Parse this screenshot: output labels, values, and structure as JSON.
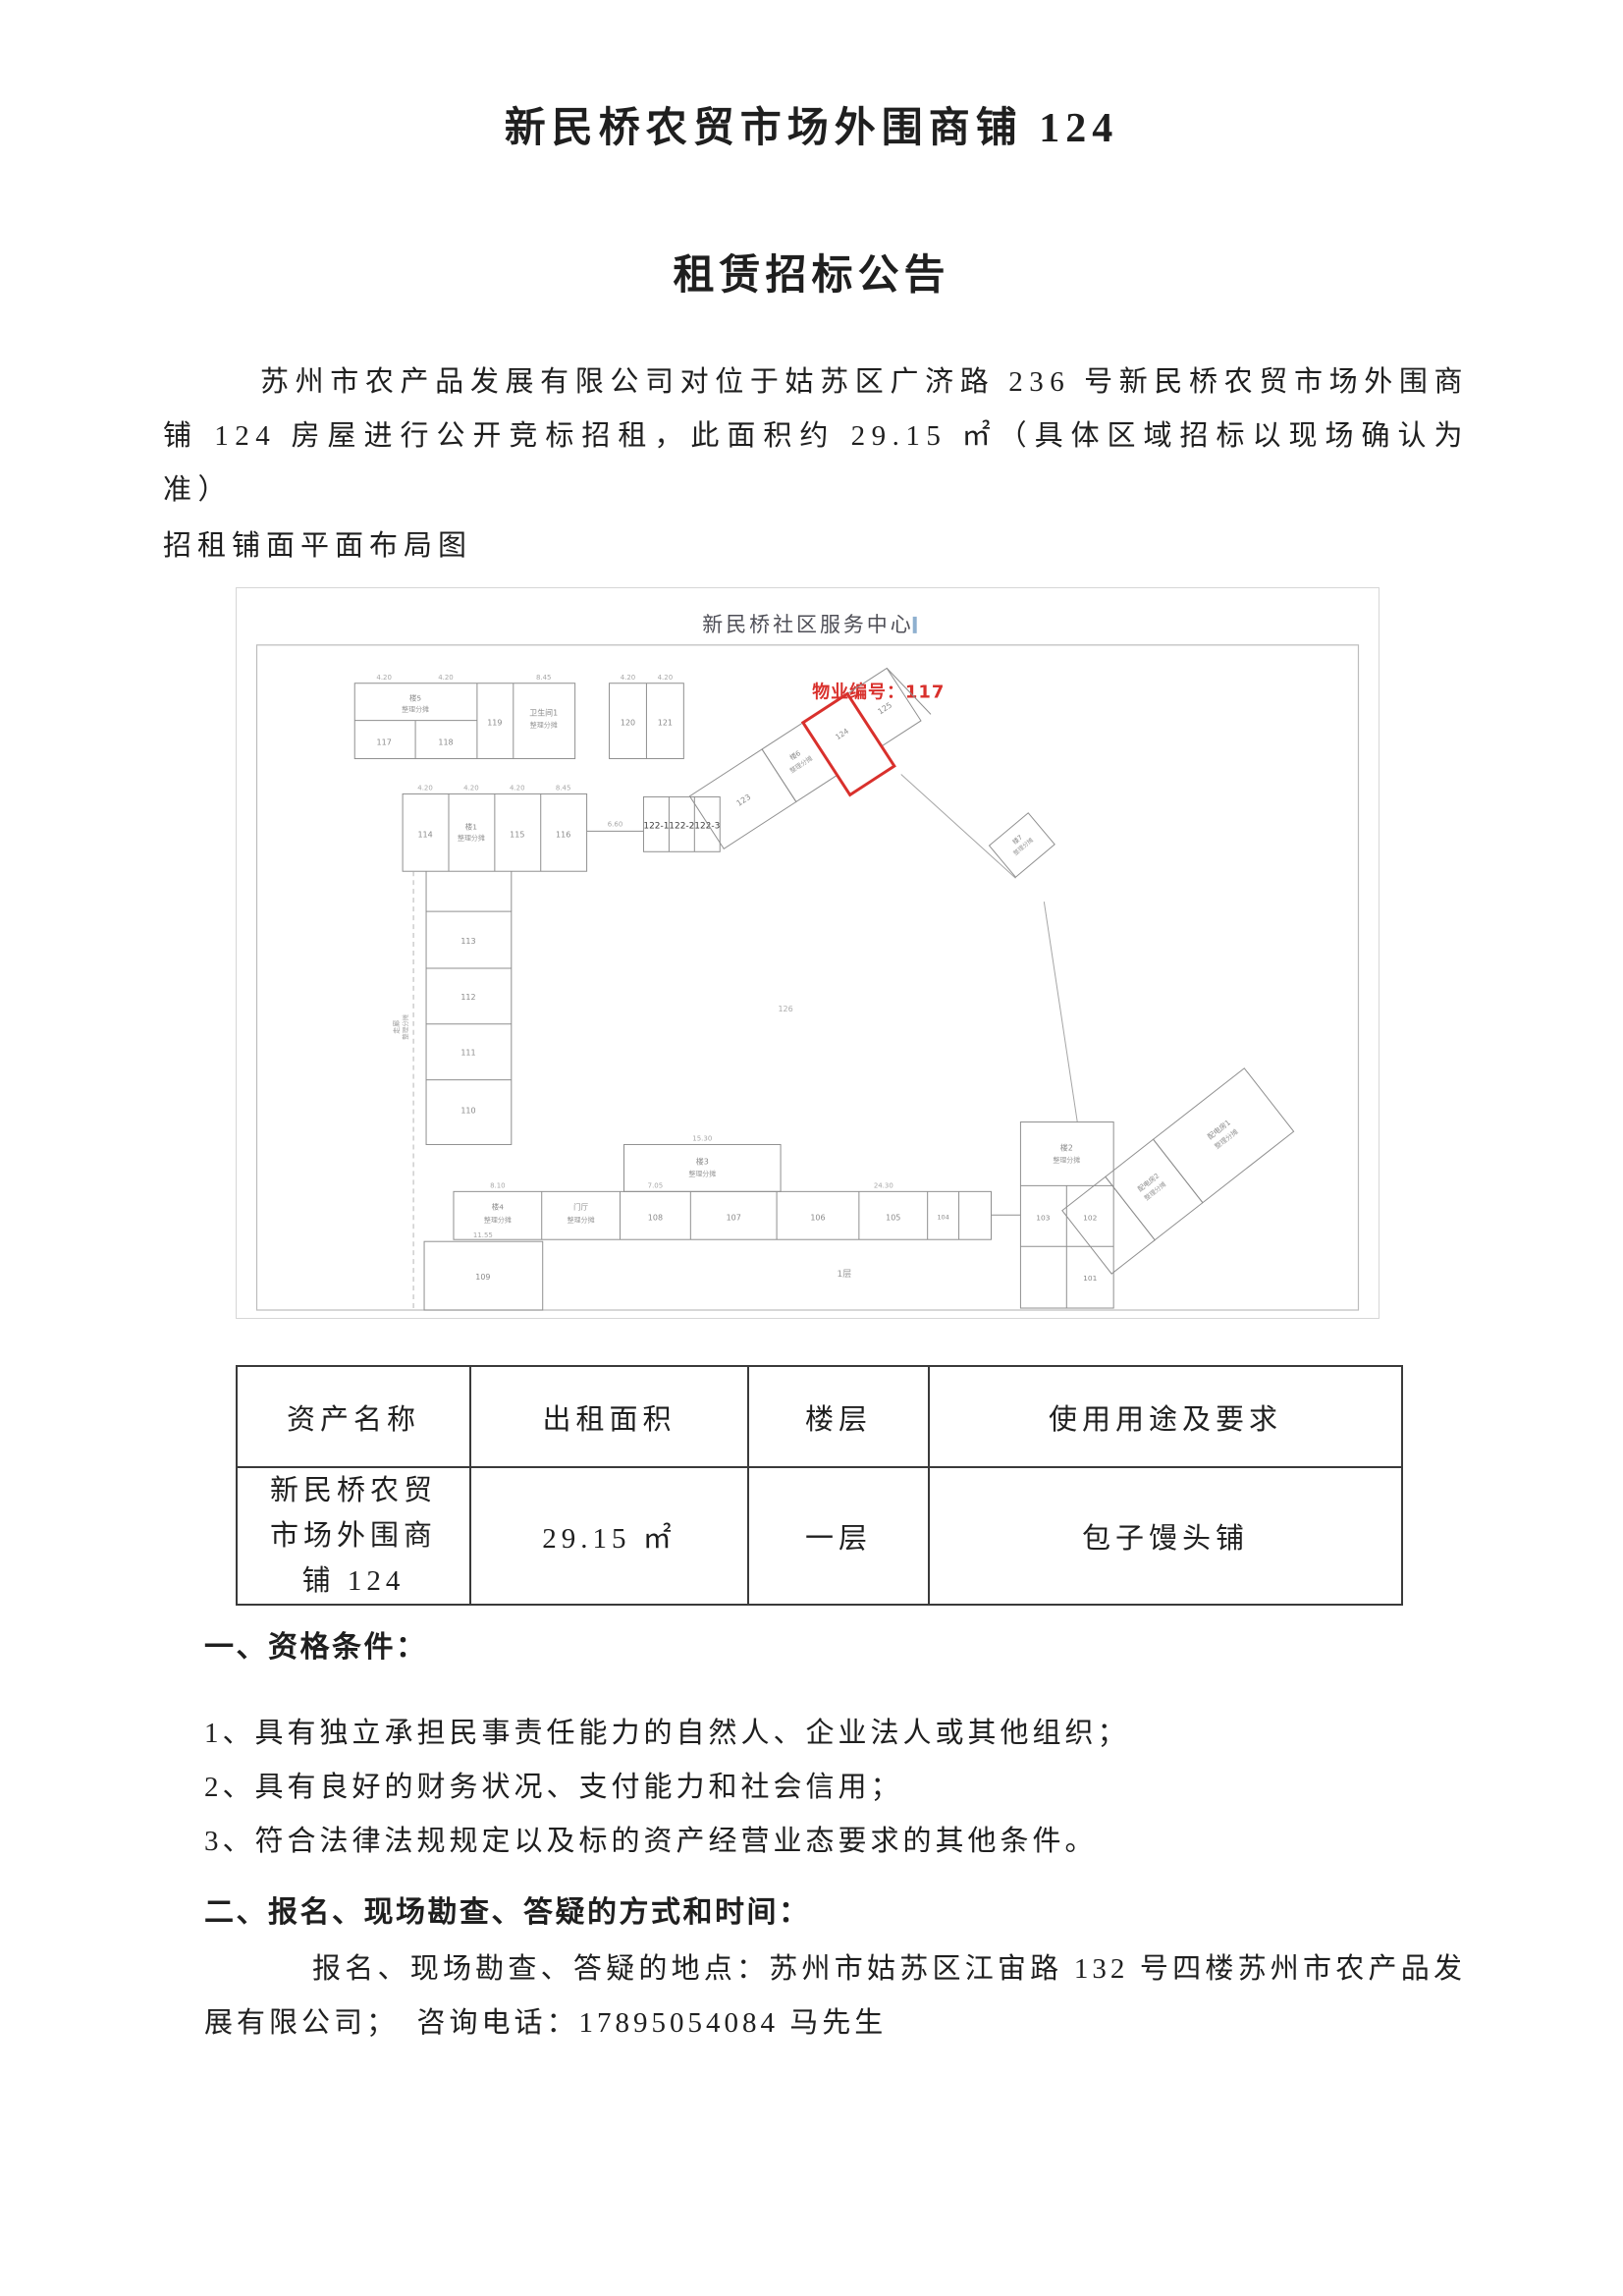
{
  "doc": {
    "title": "新民桥农贸市场外围商铺 124",
    "subtitle": "租赁招标公告",
    "intro": "苏州市农产品发展有限公司对位于姑苏区广济路 236 号新民桥农贸市场外围商铺 124 房屋进行公开竞标招租，此面积约 29.15 ㎡（具体区域招标以现场确认为准）",
    "plan_caption": "招租铺面平面布局图"
  },
  "plan": {
    "title": "新民桥社区服务中心",
    "property_no": "物业编号：117",
    "share": "整理分摊",
    "rooms": {
      "b5": "楼5",
      "r117": "117",
      "r118": "118",
      "r119": "119",
      "toilet": "卫生间1",
      "r120": "120",
      "r121": "121",
      "r114": "114",
      "b1": "楼1",
      "r115": "115",
      "r116": "116",
      "r122_1": "122-1",
      "r122_2": "122-2",
      "r122_3": "122-3",
      "r123": "123",
      "b6": "楼6",
      "r124": "124",
      "r125": "125",
      "r126": "126",
      "b7": "楼7",
      "r113": "113",
      "r112": "112",
      "r111": "111",
      "r110": "110",
      "corridor": "走廊",
      "b3": "楼3",
      "b4": "楼4",
      "hall": "门厅",
      "r109": "109",
      "r108": "108",
      "r107": "107",
      "r106": "106",
      "r105": "105",
      "r104": "104",
      "b2": "楼2",
      "r101": "101",
      "r102": "102",
      "r103": "103",
      "power1": "配电房1",
      "power2": "配电房2",
      "floor": "1层"
    },
    "dims": [
      "4.20",
      "8.45",
      "15.30",
      "8.10",
      "11.55",
      "7.05",
      "24.30",
      "6.60"
    ]
  },
  "table": {
    "headers": [
      "资产名称",
      "出租面积",
      "楼层",
      "使用用途及要求"
    ],
    "row": {
      "asset": "新民桥农贸市场外围商铺 124",
      "area": "29.15 ㎡",
      "floor": "一层",
      "usage": "包子馒头铺"
    }
  },
  "sections": {
    "s1": {
      "heading": "一、资格条件：",
      "items": [
        "1、具有独立承担民事责任能力的自然人、企业法人或其他组织；",
        "2、具有良好的财务状况、支付能力和社会信用；",
        "3、符合法律法规规定以及标的资产经营业态要求的其他条件。"
      ]
    },
    "s2": {
      "heading": "二、报名、现场勘查、答疑的方式和时间：",
      "body": "报名、现场勘查、答疑的地点：苏州市姑苏区江宙路 132 号四楼苏州市农产品发展有限公司；　咨询电话：17895054084 马先生"
    }
  },
  "colors": {
    "highlight": "#d9302c",
    "plan_line": "#8f8f8f"
  }
}
